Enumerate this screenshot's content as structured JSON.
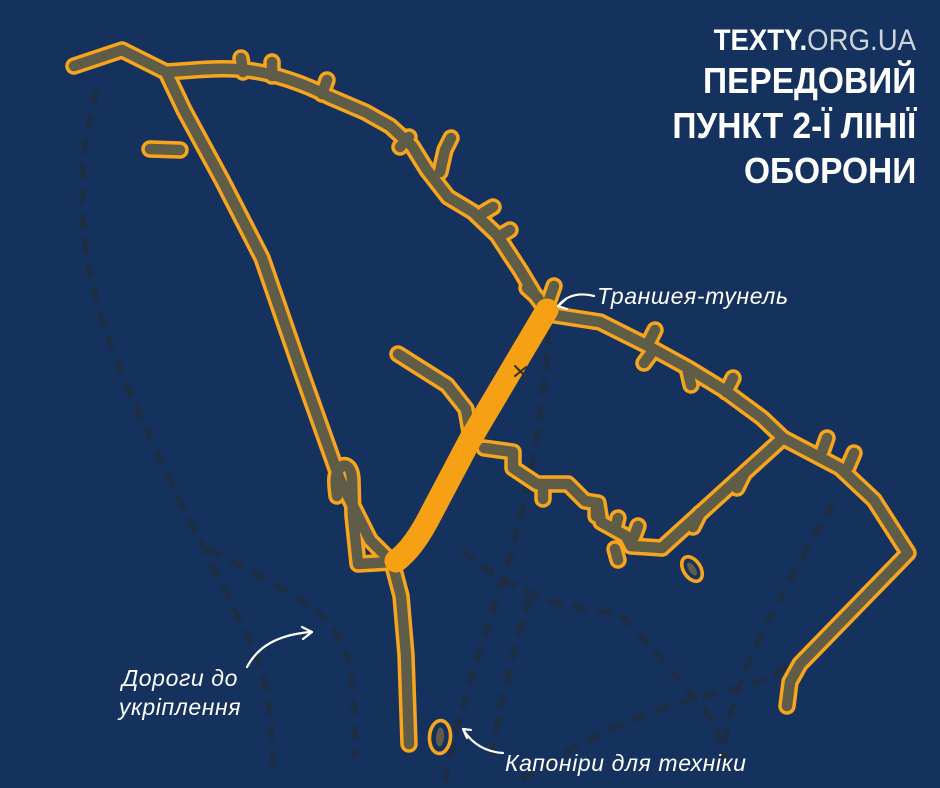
{
  "brand": {
    "bold": "TEXTY.",
    "rest": "ORG.UA"
  },
  "title": {
    "line1": "ПЕРЕДОВИЙ",
    "line2": "ПУНКТ 2-Ї ЛІНІЇ",
    "line3": "ОБОРОНИ"
  },
  "labels": {
    "tunnel": "Траншея-тунель",
    "roads_line1": "Дороги до",
    "roads_line2": "укріплення",
    "caponiers": "Капоніри для техніки"
  },
  "legend": {
    "trench_meaning": "траншеї",
    "tunnel_meaning": "траншея-тунель",
    "roads_meaning": "дороги до укріплення",
    "ovals_meaning": "капоніри для техніки"
  },
  "colors": {
    "background": "#15325e",
    "road_dash": "#1c2d44",
    "trench_fill": "#5f5c48",
    "trench_outline": "#f7a51d",
    "tunnel": "#f6a013",
    "text": "#ffffff",
    "brand_rest": "#ccd3db"
  }
}
